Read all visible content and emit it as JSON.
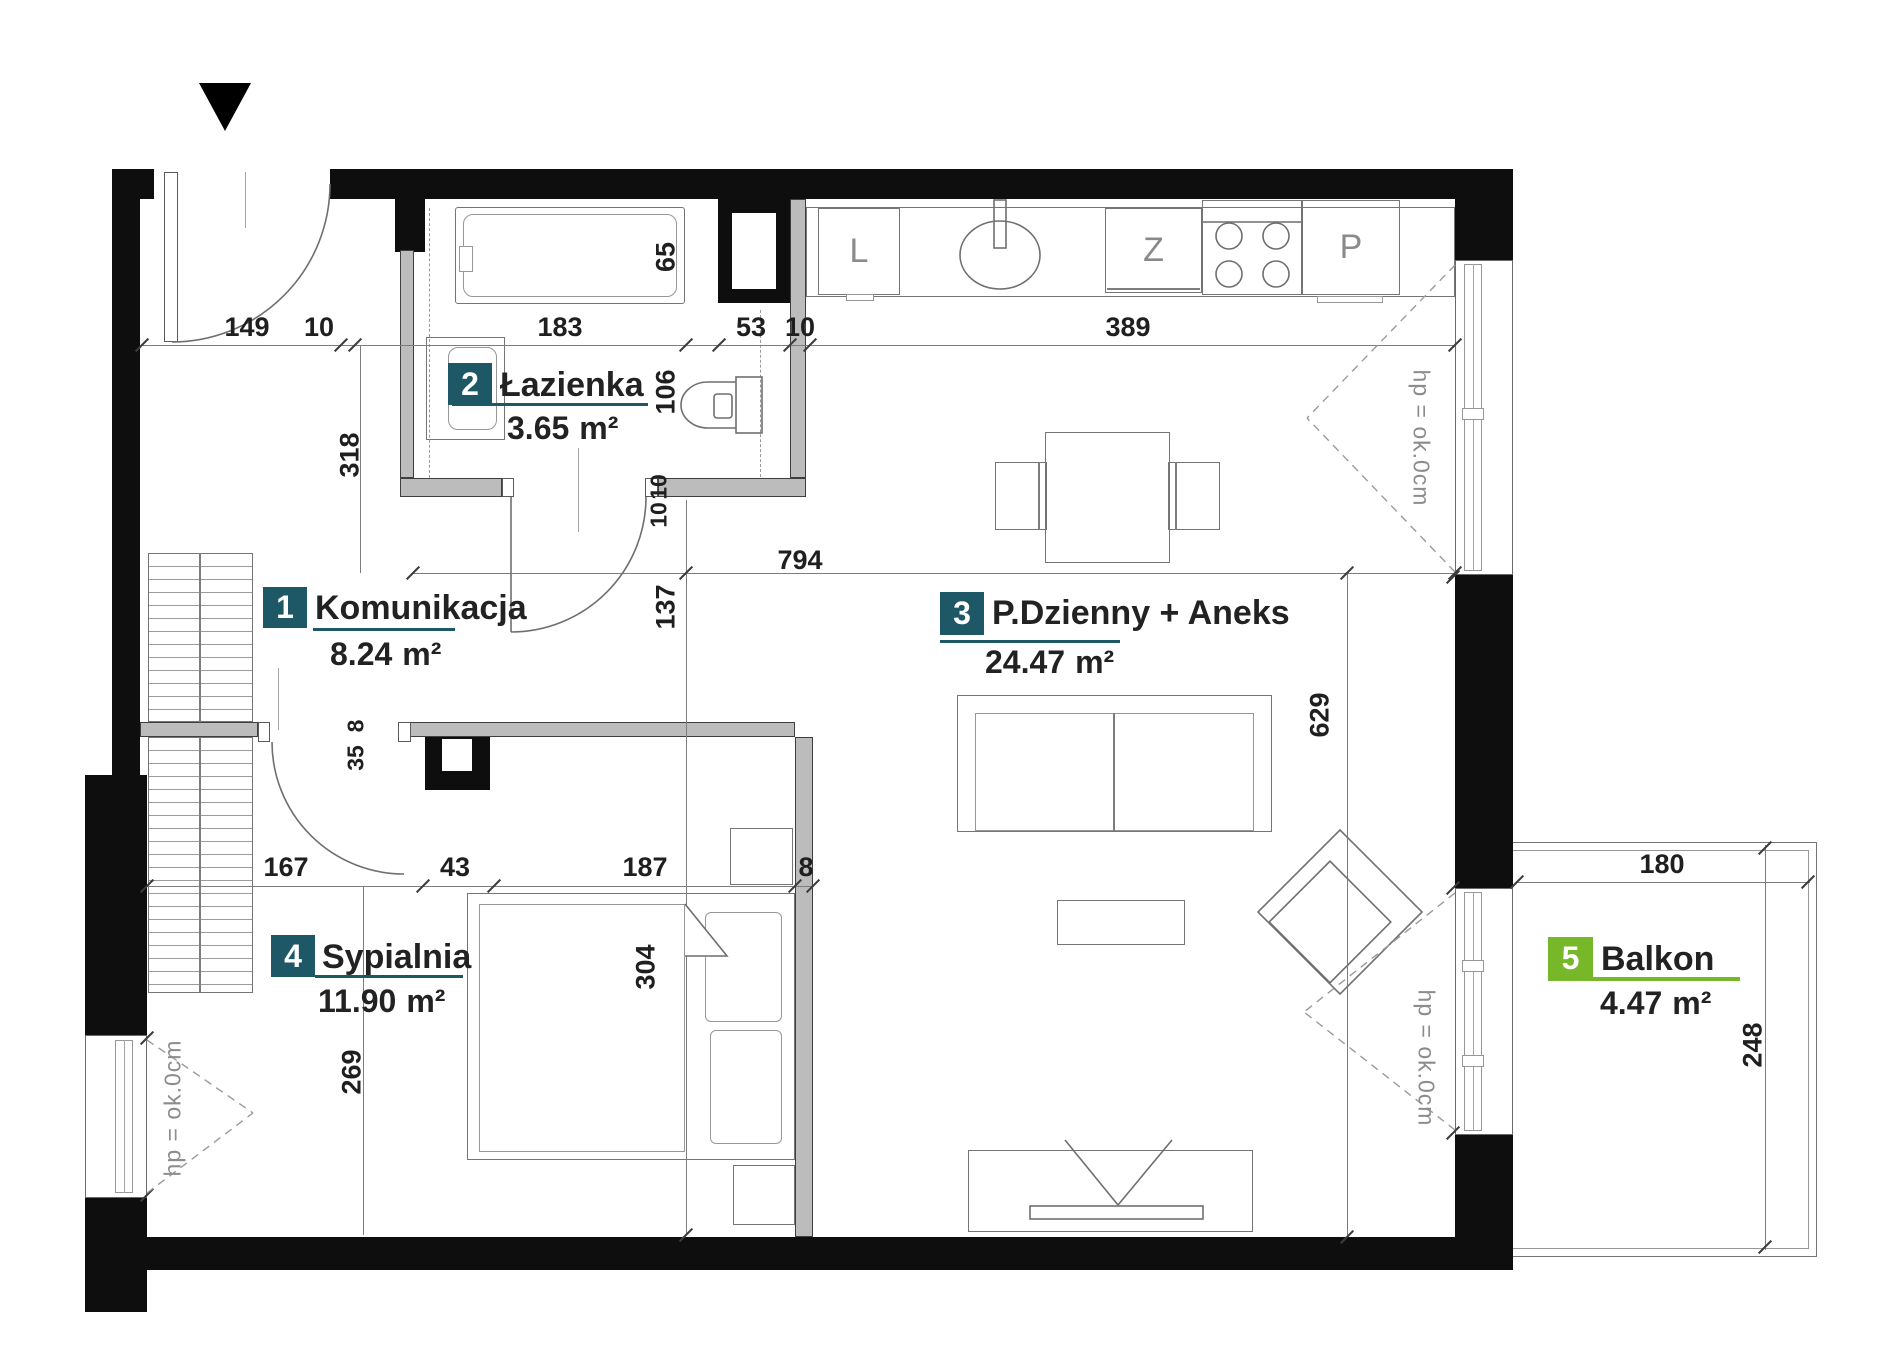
{
  "colors": {
    "wall": "#0e0e0e",
    "partition": "#bcbcbc",
    "badge_teal": "#1e5766",
    "badge_green": "#76b82a",
    "annotation_gray": "#8c8c8c"
  },
  "rooms": [
    {
      "num": "1",
      "name": "Komunikacja",
      "area": "8.24",
      "unit": "m²"
    },
    {
      "num": "2",
      "name": "Łazienka",
      "area": "3.65",
      "unit": "m²"
    },
    {
      "num": "3",
      "name": "P.Dzienny + Aneks",
      "area": "24.47",
      "unit": "m²"
    },
    {
      "num": "4",
      "name": "Sypialnia",
      "area": "11.90",
      "unit": "m²"
    },
    {
      "num": "5",
      "name": "Balkon",
      "area": "4.47",
      "unit": "m²"
    }
  ],
  "dims": {
    "h": [
      "149",
      "10",
      "183",
      "53",
      "10",
      "389"
    ],
    "b": [
      "167",
      "43",
      "187",
      "8"
    ],
    "wide": "794",
    "balcony_w": "180",
    "v": {
      "hall_height": "318",
      "tub": "65",
      "wc": "106",
      "hall": "137",
      "living": "629",
      "door_a": "35",
      "door_b": "8",
      "bedroom": "269",
      "bed": "304",
      "balcony": "248",
      "wall_a": "10",
      "wall_b": "10"
    }
  },
  "annotations": {
    "window_height": "hp = ok.0cm"
  },
  "kitchen": {
    "fridge": "L",
    "dishwasher": "Z",
    "oven": "P"
  }
}
